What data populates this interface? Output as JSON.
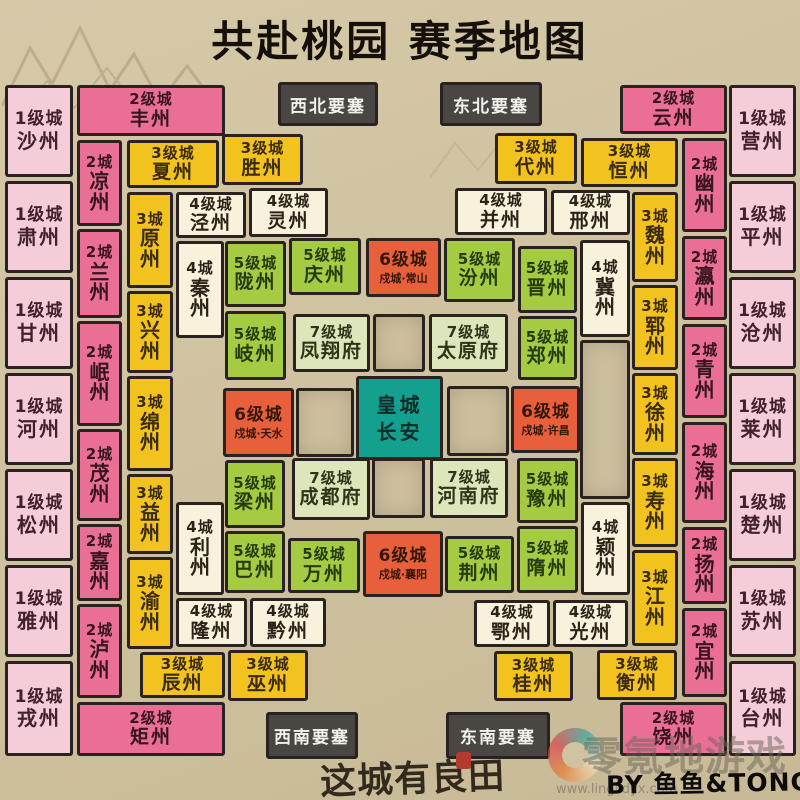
{
  "title": "共赴桃园 赛季地图",
  "palette": {
    "background": "#cfc2a0",
    "border": "#292220",
    "level1": "#f4cdd9",
    "level2": "#e96f95",
    "level3": "#f2c31e",
    "level4": "#f7f2dc",
    "level5": "#a5cb42",
    "level6": "#e75f3b",
    "level7": "#dde5ba",
    "imperial": "#13a08e",
    "fortress": "#4a4643",
    "title_color": "#16100b"
  },
  "fortresses": [
    {
      "id": "fortress-northwest",
      "label": "西北要塞",
      "x": 278,
      "y": 82,
      "w": 100,
      "h": 44
    },
    {
      "id": "fortress-northeast",
      "label": "东北要塞",
      "x": 440,
      "y": 82,
      "w": 102,
      "h": 44
    },
    {
      "id": "fortress-southwest",
      "label": "西南要塞",
      "x": 266,
      "y": 712,
      "w": 92,
      "h": 47
    },
    {
      "id": "fortress-southeast",
      "label": "东南要塞",
      "x": 446,
      "y": 712,
      "w": 104,
      "h": 47
    }
  ],
  "cities": [
    {
      "id": "shazhou",
      "type": "lv1",
      "level": "1级城",
      "name": "沙州",
      "x": 5,
      "y": 85,
      "w": 68,
      "h": 92
    },
    {
      "id": "suzhou-su4",
      "type": "lv1",
      "level": "1级城",
      "name": "肃州",
      "x": 5,
      "y": 181,
      "w": 68,
      "h": 92
    },
    {
      "id": "ganzhou",
      "type": "lv1",
      "level": "1级城",
      "name": "甘州",
      "x": 5,
      "y": 277,
      "w": 68,
      "h": 92
    },
    {
      "id": "hezhou",
      "type": "lv1",
      "level": "1级城",
      "name": "河州",
      "x": 5,
      "y": 373,
      "w": 68,
      "h": 92
    },
    {
      "id": "songzhou",
      "type": "lv1",
      "level": "1级城",
      "name": "松州",
      "x": 5,
      "y": 469,
      "w": 68,
      "h": 92
    },
    {
      "id": "yazhou",
      "type": "lv1",
      "level": "1级城",
      "name": "雅州",
      "x": 5,
      "y": 565,
      "w": 68,
      "h": 92
    },
    {
      "id": "rongzhou",
      "type": "lv1",
      "level": "1级城",
      "name": "戎州",
      "x": 5,
      "y": 661,
      "w": 68,
      "h": 95
    },
    {
      "id": "yingzhou",
      "type": "lv1",
      "level": "1级城",
      "name": "营州",
      "x": 729,
      "y": 85,
      "w": 67,
      "h": 92
    },
    {
      "id": "pingzhou",
      "type": "lv1",
      "level": "1级城",
      "name": "平州",
      "x": 729,
      "y": 181,
      "w": 67,
      "h": 92
    },
    {
      "id": "cangzhou",
      "type": "lv1",
      "level": "1级城",
      "name": "沧州",
      "x": 729,
      "y": 277,
      "w": 67,
      "h": 92
    },
    {
      "id": "laizhou",
      "type": "lv1",
      "level": "1级城",
      "name": "莱州",
      "x": 729,
      "y": 373,
      "w": 67,
      "h": 92
    },
    {
      "id": "chuzhou",
      "type": "lv1",
      "level": "1级城",
      "name": "楚州",
      "x": 729,
      "y": 469,
      "w": 67,
      "h": 92
    },
    {
      "id": "suzhou",
      "type": "lv1",
      "level": "1级城",
      "name": "苏州",
      "x": 729,
      "y": 565,
      "w": 67,
      "h": 92
    },
    {
      "id": "taizhou",
      "type": "lv1",
      "level": "1级城",
      "name": "台州",
      "x": 729,
      "y": 661,
      "w": 67,
      "h": 95
    },
    {
      "id": "fengzhou",
      "type": "lv2",
      "level": "2级城",
      "name": "丰州",
      "x": 77,
      "y": 85,
      "w": 148,
      "h": 51
    },
    {
      "id": "juzhou",
      "type": "lv2",
      "level": "2级城",
      "name": "矩州",
      "x": 77,
      "y": 702,
      "w": 148,
      "h": 54
    },
    {
      "id": "yunzhou",
      "type": "lv2",
      "level": "2级城",
      "name": "云州",
      "x": 620,
      "y": 85,
      "w": 107,
      "h": 49
    },
    {
      "id": "raozhou",
      "type": "lv2",
      "level": "2级城",
      "name": "饶州",
      "x": 620,
      "y": 702,
      "w": 107,
      "h": 54
    },
    {
      "id": "liangzhou-cool",
      "type": "lv2",
      "level": "2城",
      "name": "凉州",
      "vert": true,
      "x": 77,
      "y": 140,
      "w": 45,
      "h": 86
    },
    {
      "id": "lanzhou",
      "type": "lv2",
      "level": "2城",
      "name": "兰州",
      "vert": true,
      "x": 77,
      "y": 229,
      "w": 45,
      "h": 89
    },
    {
      "id": "minzhou",
      "type": "lv2",
      "level": "2城",
      "name": "岷州",
      "vert": true,
      "x": 77,
      "y": 321,
      "w": 45,
      "h": 105
    },
    {
      "id": "maozhou",
      "type": "lv2",
      "level": "2城",
      "name": "茂州",
      "vert": true,
      "x": 77,
      "y": 429,
      "w": 45,
      "h": 92
    },
    {
      "id": "jiazhou",
      "type": "lv2",
      "level": "2城",
      "name": "嘉州",
      "vert": true,
      "x": 77,
      "y": 524,
      "w": 45,
      "h": 77
    },
    {
      "id": "luzhou",
      "type": "lv2",
      "level": "2城",
      "name": "泸州",
      "vert": true,
      "x": 77,
      "y": 604,
      "w": 45,
      "h": 94
    },
    {
      "id": "youzhou",
      "type": "lv2",
      "level": "2城",
      "name": "幽州",
      "vert": true,
      "x": 682,
      "y": 138,
      "w": 45,
      "h": 94
    },
    {
      "id": "yingzhou-ying2",
      "type": "lv2",
      "level": "2城",
      "name": "瀛州",
      "vert": true,
      "x": 682,
      "y": 236,
      "w": 45,
      "h": 84
    },
    {
      "id": "qingzhou",
      "type": "lv2",
      "level": "2城",
      "name": "青州",
      "vert": true,
      "x": 682,
      "y": 324,
      "w": 45,
      "h": 94
    },
    {
      "id": "haizhou",
      "type": "lv2",
      "level": "2城",
      "name": "海州",
      "vert": true,
      "x": 682,
      "y": 422,
      "w": 45,
      "h": 101
    },
    {
      "id": "yangzhou",
      "type": "lv2",
      "level": "2城",
      "name": "扬州",
      "vert": true,
      "x": 682,
      "y": 527,
      "w": 45,
      "h": 77
    },
    {
      "id": "yizhou-yi2",
      "type": "lv2",
      "level": "2城",
      "name": "宜州",
      "vert": true,
      "x": 682,
      "y": 608,
      "w": 45,
      "h": 89
    },
    {
      "id": "xiazhou",
      "type": "lv3",
      "level": "3级城",
      "name": "夏州",
      "x": 127,
      "y": 140,
      "w": 92,
      "h": 48
    },
    {
      "id": "shengzhou",
      "type": "lv3",
      "level": "3级城",
      "name": "胜州",
      "x": 222,
      "y": 134,
      "w": 81,
      "h": 51
    },
    {
      "id": "daizhou",
      "type": "lv3",
      "level": "3级城",
      "name": "代州",
      "x": 495,
      "y": 133,
      "w": 82,
      "h": 51
    },
    {
      "id": "hengzhou-heng2",
      "type": "lv3",
      "level": "3级城",
      "name": "恒州",
      "x": 581,
      "y": 138,
      "w": 97,
      "h": 49
    },
    {
      "id": "chenzhou",
      "type": "lv3",
      "level": "3级城",
      "name": "辰州",
      "x": 140,
      "y": 652,
      "w": 85,
      "h": 46
    },
    {
      "id": "wuzhou",
      "type": "lv3",
      "level": "3级城",
      "name": "巫州",
      "x": 228,
      "y": 650,
      "w": 80,
      "h": 51
    },
    {
      "id": "guizhou",
      "type": "lv3",
      "level": "3级城",
      "name": "桂州",
      "x": 494,
      "y": 651,
      "w": 79,
      "h": 50
    },
    {
      "id": "hengzhou",
      "type": "lv3",
      "level": "3级城",
      "name": "衡州",
      "x": 597,
      "y": 650,
      "w": 80,
      "h": 50
    },
    {
      "id": "yuanzhou",
      "type": "lv3",
      "level": "3城",
      "name": "原州",
      "vert": true,
      "x": 127,
      "y": 192,
      "w": 46,
      "h": 96
    },
    {
      "id": "xingzhou-xing1",
      "type": "lv3",
      "level": "3城",
      "name": "兴州",
      "vert": true,
      "x": 127,
      "y": 291,
      "w": 46,
      "h": 82
    },
    {
      "id": "mianzhou",
      "type": "lv3",
      "level": "3城",
      "name": "绵州",
      "vert": true,
      "x": 127,
      "y": 376,
      "w": 46,
      "h": 95
    },
    {
      "id": "yizhou",
      "type": "lv3",
      "level": "3城",
      "name": "益州",
      "vert": true,
      "x": 127,
      "y": 474,
      "w": 46,
      "h": 80
    },
    {
      "id": "yuzhou-yu2",
      "type": "lv3",
      "level": "3城",
      "name": "渝州",
      "vert": true,
      "x": 127,
      "y": 557,
      "w": 46,
      "h": 92
    },
    {
      "id": "weizhou",
      "type": "lv3",
      "level": "3城",
      "name": "魏州",
      "vert": true,
      "x": 632,
      "y": 192,
      "w": 46,
      "h": 90
    },
    {
      "id": "yunzhou-yun4",
      "type": "lv3",
      "level": "3城",
      "name": "郓州",
      "vert": true,
      "x": 632,
      "y": 285,
      "w": 46,
      "h": 85
    },
    {
      "id": "xuzhou",
      "type": "lv3",
      "level": "3城",
      "name": "徐州",
      "vert": true,
      "x": 632,
      "y": 373,
      "w": 46,
      "h": 82
    },
    {
      "id": "shouzhou",
      "type": "lv3",
      "level": "3城",
      "name": "寿州",
      "vert": true,
      "x": 632,
      "y": 458,
      "w": 46,
      "h": 89
    },
    {
      "id": "jiangzhou",
      "type": "lv3",
      "level": "3城",
      "name": "江州",
      "vert": true,
      "x": 632,
      "y": 550,
      "w": 46,
      "h": 96
    },
    {
      "id": "jingzhou-jing1",
      "type": "lv4",
      "level": "4级城",
      "name": "泾州",
      "x": 176,
      "y": 192,
      "w": 70,
      "h": 46
    },
    {
      "id": "lingzhou",
      "type": "lv4",
      "level": "4级城",
      "name": "灵州",
      "x": 249,
      "y": 188,
      "w": 79,
      "h": 49
    },
    {
      "id": "bingzhou",
      "type": "lv4",
      "level": "4级城",
      "name": "并州",
      "x": 455,
      "y": 188,
      "w": 92,
      "h": 47
    },
    {
      "id": "xingzhou-xing2",
      "type": "lv4",
      "level": "4级城",
      "name": "邢州",
      "x": 551,
      "y": 190,
      "w": 79,
      "h": 45
    },
    {
      "id": "longzhou",
      "type": "lv4",
      "level": "4级城",
      "name": "隆州",
      "x": 176,
      "y": 598,
      "w": 71,
      "h": 49
    },
    {
      "id": "qianzhou",
      "type": "lv4",
      "level": "4级城",
      "name": "黔州",
      "x": 250,
      "y": 598,
      "w": 76,
      "h": 49
    },
    {
      "id": "ezhou",
      "type": "lv4",
      "level": "4级城",
      "name": "鄂州",
      "x": 474,
      "y": 600,
      "w": 76,
      "h": 47
    },
    {
      "id": "guangzhou-guang1",
      "type": "lv4",
      "level": "4级城",
      "name": "光州",
      "x": 553,
      "y": 600,
      "w": 75,
      "h": 47
    },
    {
      "id": "qinzhou",
      "type": "lv4",
      "level": "4城",
      "name": "秦州",
      "vert": true,
      "x": 176,
      "y": 241,
      "w": 48,
      "h": 97
    },
    {
      "id": "jizhou",
      "type": "lv4",
      "level": "4城",
      "name": "冀州",
      "vert": true,
      "x": 580,
      "y": 240,
      "w": 50,
      "h": 97
    },
    {
      "id": "lizhou",
      "type": "lv4",
      "level": "4城",
      "name": "利州",
      "vert": true,
      "x": 176,
      "y": 502,
      "w": 48,
      "h": 93
    },
    {
      "id": "yingzhou-ying3",
      "type": "lv4",
      "level": "4城",
      "name": "颖州",
      "vert": true,
      "x": 581,
      "y": 502,
      "w": 49,
      "h": 93
    },
    {
      "id": "longzhou-long3",
      "type": "lv5",
      "level": "5级城",
      "name": "陇州",
      "x": 225,
      "y": 241,
      "w": 61,
      "h": 66
    },
    {
      "id": "qingzhou-qing4",
      "type": "lv5",
      "level": "5级城",
      "name": "庆州",
      "x": 289,
      "y": 238,
      "w": 72,
      "h": 57
    },
    {
      "id": "fenzhou",
      "type": "lv5",
      "level": "5级城",
      "name": "汾州",
      "x": 444,
      "y": 238,
      "w": 71,
      "h": 64
    },
    {
      "id": "jinzhou",
      "type": "lv5",
      "level": "5级城",
      "name": "晋州",
      "x": 518,
      "y": 246,
      "w": 59,
      "h": 67
    },
    {
      "id": "qizhou",
      "type": "lv5",
      "level": "5级城",
      "name": "岐州",
      "x": 225,
      "y": 311,
      "w": 61,
      "h": 69
    },
    {
      "id": "zhengzhou",
      "type": "lv5",
      "level": "5级城",
      "name": "郑州",
      "x": 518,
      "y": 316,
      "w": 59,
      "h": 64
    },
    {
      "id": "liangzhou",
      "type": "lv5",
      "level": "5级城",
      "name": "梁州",
      "x": 225,
      "y": 460,
      "w": 60,
      "h": 68
    },
    {
      "id": "yuzhou",
      "type": "lv5",
      "level": "5级城",
      "name": "豫州",
      "x": 517,
      "y": 458,
      "w": 61,
      "h": 65
    },
    {
      "id": "bazhou",
      "type": "lv5",
      "level": "5级城",
      "name": "巴州",
      "x": 225,
      "y": 531,
      "w": 60,
      "h": 62
    },
    {
      "id": "wanzhou",
      "type": "lv5",
      "level": "5级城",
      "name": "万州",
      "x": 288,
      "y": 538,
      "w": 72,
      "h": 55
    },
    {
      "id": "jingzhou",
      "type": "lv5",
      "level": "5级城",
      "name": "荆州",
      "x": 445,
      "y": 536,
      "w": 69,
      "h": 57
    },
    {
      "id": "suizhou",
      "type": "lv5",
      "level": "5级城",
      "name": "隋州",
      "x": 517,
      "y": 526,
      "w": 61,
      "h": 67
    },
    {
      "id": "shucheng-changshan",
      "type": "lv6",
      "level": "6级城",
      "name": "戍城·常山",
      "x": 366,
      "y": 238,
      "w": 75,
      "h": 59
    },
    {
      "id": "shucheng-tianshui",
      "type": "lv6",
      "level": "6级城",
      "name": "戍城·天水",
      "x": 223,
      "y": 388,
      "w": 71,
      "h": 69
    },
    {
      "id": "shucheng-xuchang",
      "type": "lv6",
      "level": "6级城",
      "name": "戍城·许昌",
      "x": 511,
      "y": 386,
      "w": 69,
      "h": 67
    },
    {
      "id": "shucheng-xiangyang",
      "type": "lv6",
      "level": "6级城",
      "name": "戍城·襄阳",
      "x": 363,
      "y": 531,
      "w": 80,
      "h": 66
    },
    {
      "id": "fengxiangfu",
      "type": "lv7",
      "level": "7级城",
      "name": "凤翔府",
      "x": 293,
      "y": 314,
      "w": 77,
      "h": 58
    },
    {
      "id": "taiyuanfu",
      "type": "lv7",
      "level": "7级城",
      "name": "太原府",
      "x": 429,
      "y": 314,
      "w": 79,
      "h": 58
    },
    {
      "id": "chengdufu",
      "type": "lv7",
      "level": "7级城",
      "name": "成都府",
      "x": 292,
      "y": 458,
      "w": 78,
      "h": 62
    },
    {
      "id": "henanfu",
      "type": "lv7",
      "level": "7级城",
      "name": "河南府",
      "x": 430,
      "y": 458,
      "w": 78,
      "h": 60
    },
    {
      "id": "huangcheng-changan",
      "type": "huang",
      "level": "皇城",
      "name": "长安",
      "x": 356,
      "y": 376,
      "w": 87,
      "h": 84
    }
  ],
  "empty_cells": [
    {
      "x": 373,
      "y": 314,
      "w": 52,
      "h": 58
    },
    {
      "x": 296,
      "y": 388,
      "w": 58,
      "h": 69
    },
    {
      "x": 447,
      "y": 386,
      "w": 62,
      "h": 70
    },
    {
      "x": 372,
      "y": 458,
      "w": 53,
      "h": 60
    },
    {
      "x": 580,
      "y": 340,
      "w": 50,
      "h": 159
    }
  ],
  "credits": {
    "logo": "这城有良田",
    "byline": "BY 鱼鱼&TONG",
    "watermark_brand": "零氪地游戏",
    "watermark_url": "www.linglidyx.com"
  }
}
